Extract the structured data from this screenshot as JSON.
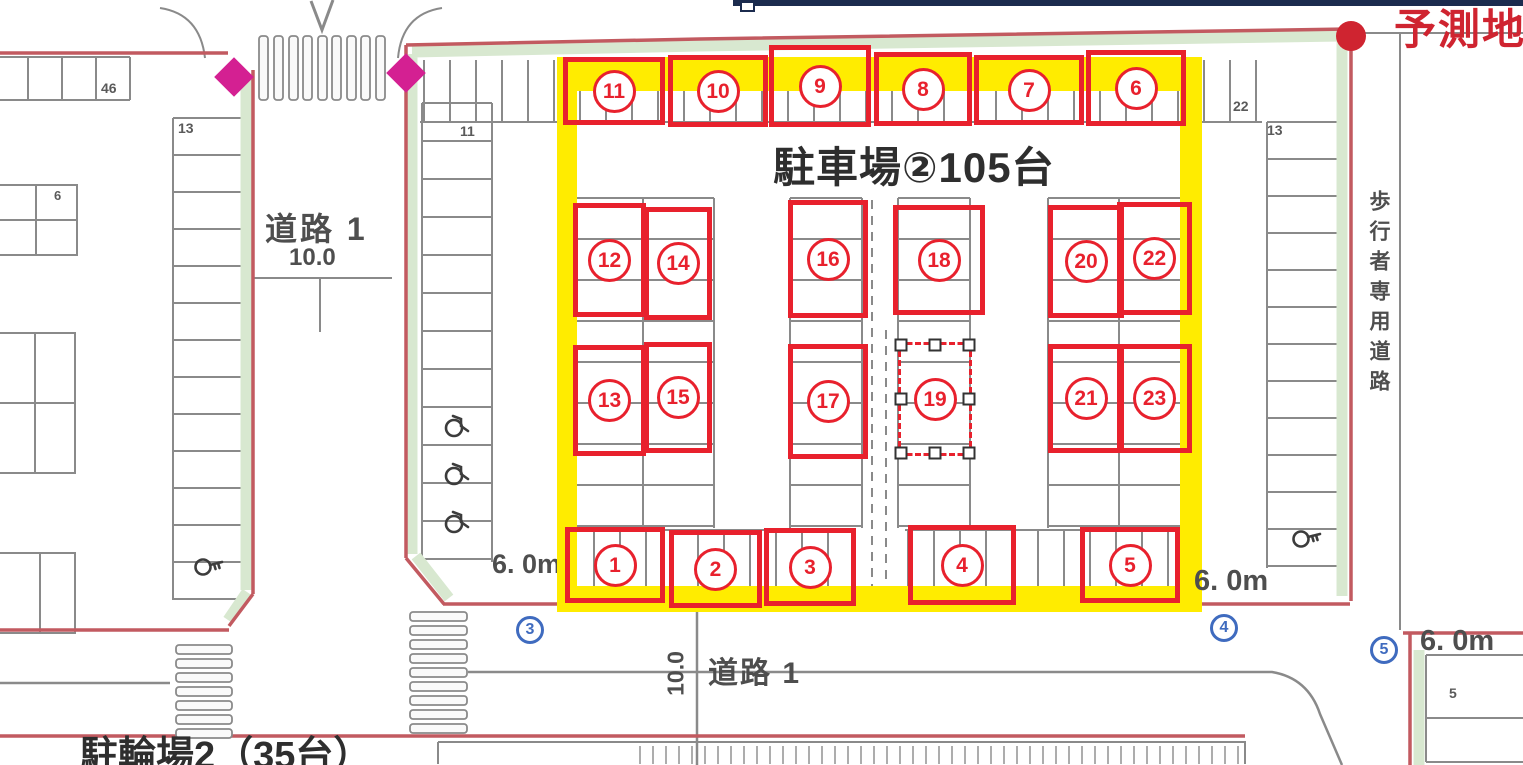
{
  "colors": {
    "annotation_red": "#e8212d",
    "highlight_yellow": "#ffec00",
    "boundary_red": "#c25a60",
    "band_green": "#d8e8d0",
    "diamond_magenta": "#d42092",
    "reference_blue": "#3f6bbf",
    "predicted_red": "#cf2430",
    "linework_gray": "#8a8a8a",
    "text_dark": "#2e2e2e",
    "text_gray": "#4e4e4e",
    "top_bar_navy": "#1b2b4e"
  },
  "labels": {
    "predicted_site": "予測地",
    "site_title": "駐車場②105台",
    "road_left_name": "道路 1",
    "road_left_width": "10.0",
    "road_bottom_name": "道路 1",
    "road_bottom_width": "10.0",
    "pedestrian_road": "歩行者専用道路",
    "bicycle_parking": "駐輪場2（35台）",
    "dim_left": "6. 0m",
    "dim_right": "6. 0m",
    "dim_far_right": "6. 0m",
    "stall_count_left_row": "46",
    "stall_count_left_col": "13",
    "stall_count_left_block": "6",
    "stall_count_inner_left_col": "11",
    "stall_count_top_right": "22",
    "stall_count_right_col": "13",
    "stall_count_bottom_right": "5"
  },
  "annotation_boxes": [
    {
      "num": "11"
    },
    {
      "num": "10"
    },
    {
      "num": "9"
    },
    {
      "num": "8"
    },
    {
      "num": "7"
    },
    {
      "num": "6"
    },
    {
      "num": "12"
    },
    {
      "num": "14"
    },
    {
      "num": "16"
    },
    {
      "num": "18"
    },
    {
      "num": "20"
    },
    {
      "num": "22"
    },
    {
      "num": "13"
    },
    {
      "num": "15"
    },
    {
      "num": "17"
    },
    {
      "num": "19",
      "selected": true
    },
    {
      "num": "21"
    },
    {
      "num": "23"
    },
    {
      "num": "1"
    },
    {
      "num": "2"
    },
    {
      "num": "3"
    },
    {
      "num": "4"
    },
    {
      "num": "5"
    }
  ],
  "reference_points": [
    {
      "num": "3"
    },
    {
      "num": "4"
    },
    {
      "num": "5"
    }
  ]
}
